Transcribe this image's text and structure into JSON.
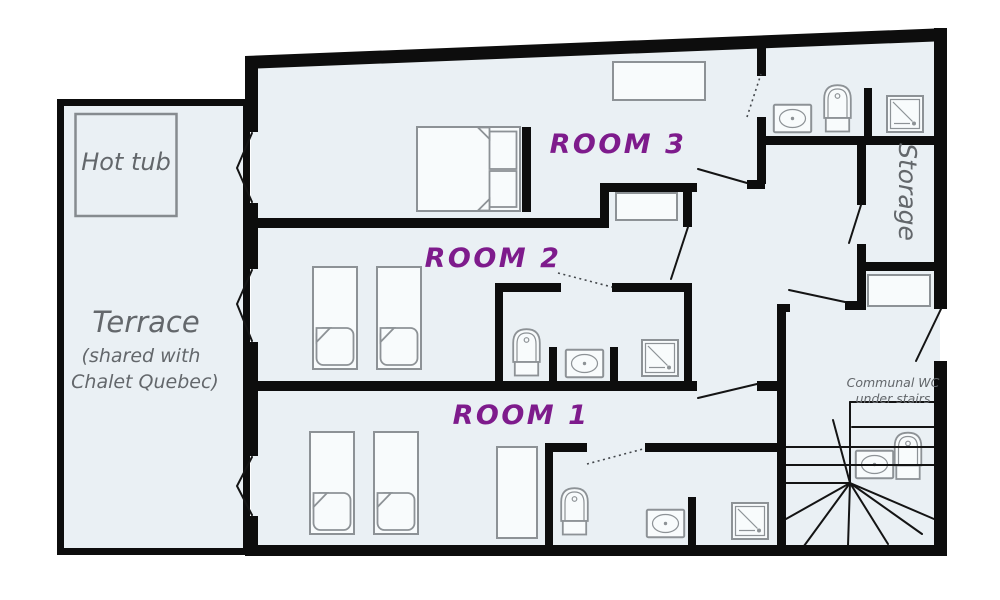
{
  "floorplan": {
    "rooms": {
      "room1_label": "ROOM 1",
      "room2_label": "ROOM 2",
      "room3_label": "ROOM 3"
    },
    "outdoor": {
      "hot_tub_label": "Hot tub",
      "terrace_label": "Terrace",
      "terrace_note_line1": "(shared with",
      "terrace_note_line2": "Chalet Quebec)"
    },
    "service": {
      "storage_label": "Storage",
      "communal_wc_line1": "Communal WC",
      "communal_wc_line2": "under stairs"
    },
    "colors": {
      "floor": "#eaf0f4",
      "wall": "#0d0d0d",
      "room_label": "#7e1b8c",
      "annotation": "#63676b",
      "furniture": "#8d9296"
    }
  }
}
